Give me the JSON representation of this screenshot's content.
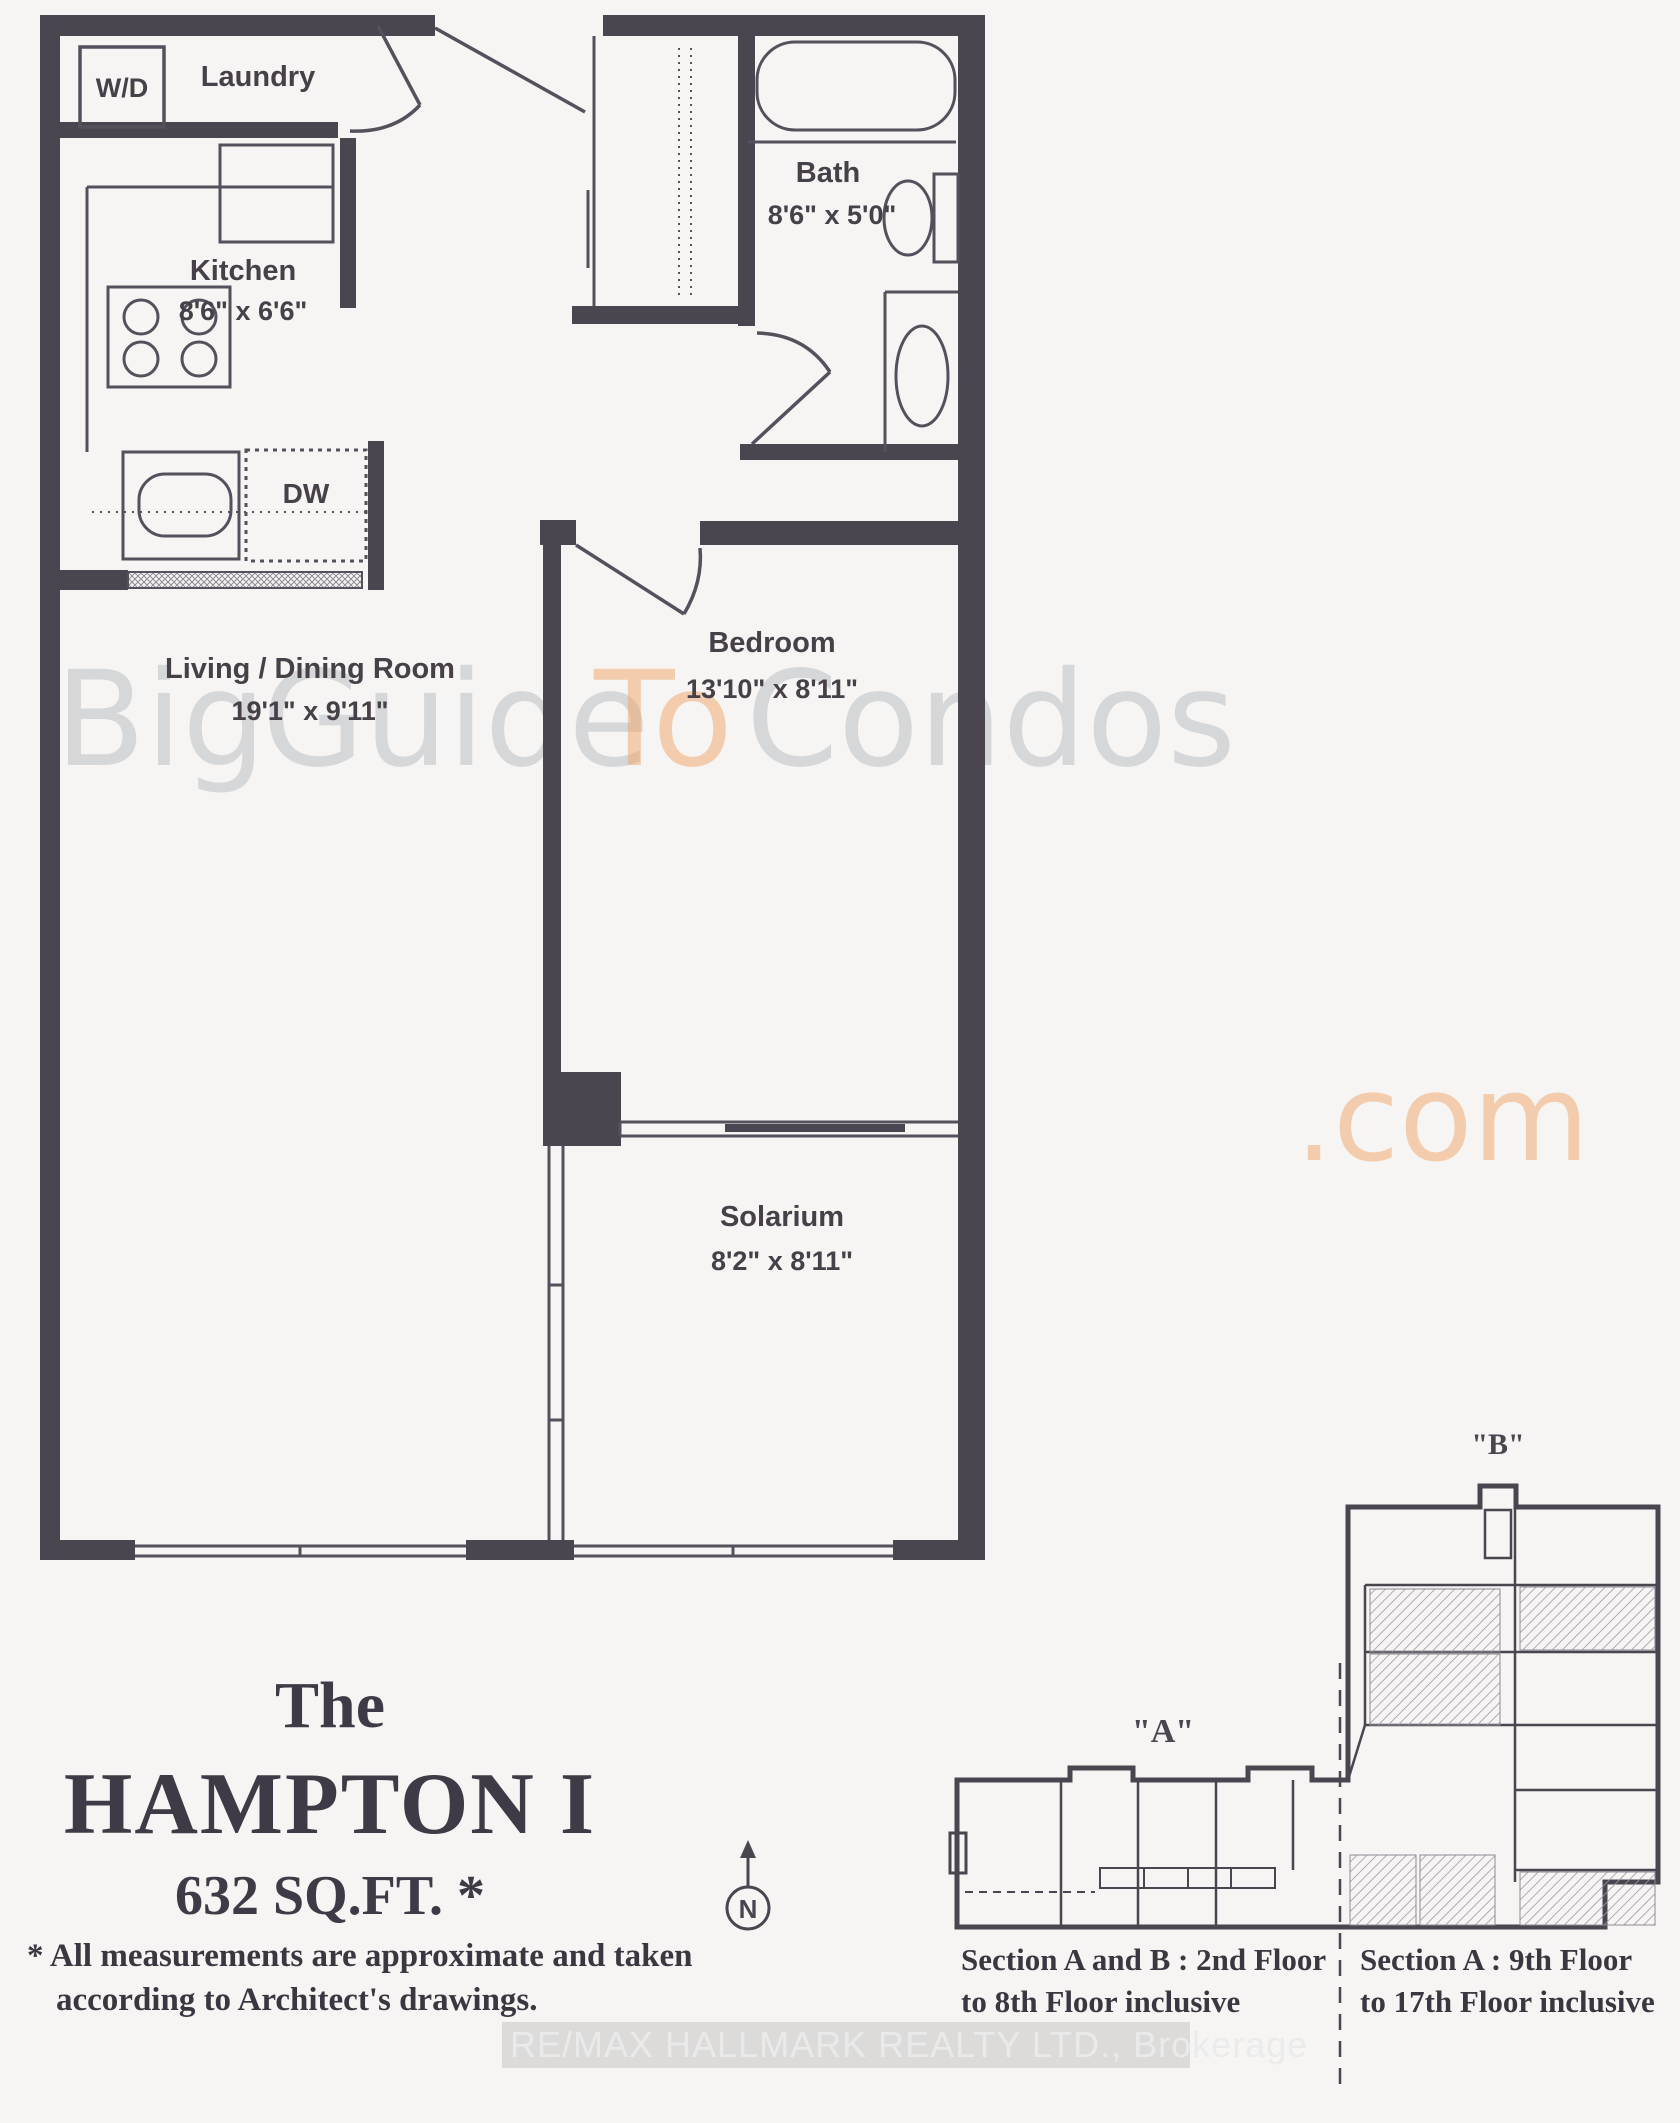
{
  "rooms": {
    "laundry": {
      "name": "Laundry"
    },
    "kitchen": {
      "name": "Kitchen",
      "dims": "8'6\" x 6'6\""
    },
    "bath": {
      "name": "Bath",
      "dims": "8'6\" x 5'0\""
    },
    "living": {
      "name": "Living / Dining Room",
      "dims": "19'1\" x 9'11\""
    },
    "bedroom": {
      "name": "Bedroom",
      "dims": "13'10\" x 8'11\""
    },
    "solarium": {
      "name": "Solarium",
      "dims": "8'2\" x 8'11\""
    }
  },
  "fixtures": {
    "washer_dryer": "W/D",
    "dishwasher": "DW"
  },
  "title": {
    "prefix": "The",
    "name": "HAMPTON  I",
    "area": "632 SQ.FT. *"
  },
  "footnote": {
    "line1": "* All measurements are approximate and taken",
    "line2": "according to Architect's drawings."
  },
  "watermark": {
    "big": "Big",
    "guide": "Guide",
    "to": "To",
    "condos": "Condos",
    "dotcom": ".com",
    "brokerage": "RE/MAX HALLMARK REALTY LTD., Brokerage"
  },
  "keyplan": {
    "section_a": "\"A\"",
    "section_b": "\"B\"",
    "north": "N",
    "caption_left_line1": "Section A and B : 2nd Floor",
    "caption_left_line2": "to 8th Floor inclusive",
    "caption_right_line1": "Section A : 9th Floor",
    "caption_right_line2": "to 17th Floor inclusive"
  },
  "colors": {
    "wall": "#4b4550",
    "thin_line": "#55505c",
    "label": "#474049",
    "watermark_gray": "#a9b0b7",
    "watermark_orange": "#f0a467",
    "paper": "#f6f5f3"
  }
}
